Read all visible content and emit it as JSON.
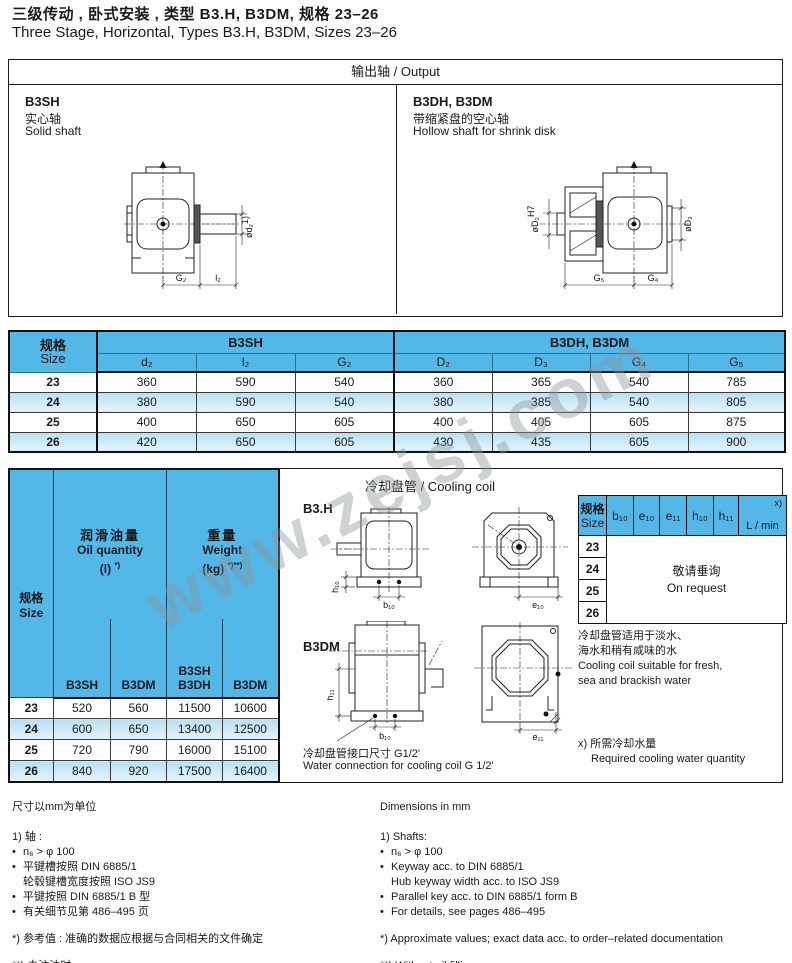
{
  "page": {
    "title_zh": "三级传动 , 卧式安装 , 类型 B3.H, B3DM, 规格 23–26",
    "title_en": "Three Stage, Horizontal, Types B3.H, B3DM, Sizes 23–26",
    "watermark": "www.zejsj.com"
  },
  "output": {
    "header": "输出轴 / Output",
    "left": {
      "type": "B3SH",
      "desc_zh": "实心轴",
      "desc_en": "Solid shaft",
      "labels": {
        "dia": "ød₂",
        "dia_sup": "1)",
        "g": "G₂",
        "l": "l₂"
      }
    },
    "right": {
      "type": "B3DH, B3DM",
      "desc_zh": "带缩紧盘的空心轴",
      "desc_en": "Hollow shaft for shrink disk",
      "labels": {
        "bore": "øD₂",
        "bore_sup": "H7",
        "d3": "øD₃",
        "g5": "G₅",
        "g4": "G₄"
      }
    }
  },
  "dim_table": {
    "size_zh": "规格",
    "size_en": "Size",
    "group1": "B3SH",
    "group2": "B3DH, B3DM",
    "cols": [
      "d₂",
      "l₂",
      "G₂",
      "D₂",
      "D₃",
      "G₄",
      "G₅"
    ],
    "rows": [
      {
        "size": "23",
        "v": [
          "360",
          "590",
          "540",
          "360",
          "365",
          "540",
          "785"
        ]
      },
      {
        "size": "24",
        "v": [
          "380",
          "590",
          "540",
          "380",
          "385",
          "540",
          "805"
        ]
      },
      {
        "size": "25",
        "v": [
          "400",
          "650",
          "605",
          "400",
          "405",
          "605",
          "875"
        ]
      },
      {
        "size": "26",
        "v": [
          "420",
          "650",
          "605",
          "430",
          "435",
          "605",
          "900"
        ]
      }
    ]
  },
  "oil_table": {
    "size_zh": "规格",
    "size_en": "Size",
    "oil_zh": "润滑油量",
    "oil_en": "Oil quantity",
    "oil_unit": "(l)",
    "oil_sup": "*)",
    "wt_zh": "重量",
    "wt_en": "Weight",
    "wt_unit": "(kg)",
    "wt_sup": "*)**)",
    "sub1": "B3SH",
    "sub2": "B3DM",
    "sub3a": "B3SH",
    "sub3b": "B3DH",
    "sub4": "B3DM",
    "rows": [
      {
        "size": "23",
        "v": [
          "520",
          "560",
          "11500",
          "10600"
        ]
      },
      {
        "size": "24",
        "v": [
          "600",
          "650",
          "13400",
          "12500"
        ]
      },
      {
        "size": "25",
        "v": [
          "720",
          "790",
          "16000",
          "15100"
        ]
      },
      {
        "size": "26",
        "v": [
          "840",
          "920",
          "17500",
          "16400"
        ]
      }
    ]
  },
  "cooling": {
    "title": "冷却盘管 / Cooling coil",
    "label_b3h": "B3.H",
    "label_b3dm": "B3DM",
    "labels": {
      "h10": "h₁₀",
      "b10": "b₁₀",
      "e10": "e₁₀",
      "h11": "h₁₁",
      "b10b": "b₁₀",
      "e11": "e₁₁"
    },
    "conn_zh": "冷却盘管接口尺寸 G1/2'",
    "conn_en": "Water connection for cooling coil G 1/2'",
    "table": {
      "size_zh": "规格",
      "size_en": "Size",
      "cols": [
        "b₁₀",
        "e₁₀",
        "e₁₁",
        "h₁₀",
        "h₁₁"
      ],
      "lmin": "L / min",
      "lmin_sup": "x)",
      "sizes": [
        "23",
        "24",
        "25",
        "26"
      ],
      "request_zh": "敬请垂询",
      "request_en": "On request"
    },
    "note_zh1": "冷却盘管适用于淡水、",
    "note_zh2": "海水和稍有咸味的水",
    "note_en1": "Cooling coil suitable for fresh,",
    "note_en2": "sea and brackish water",
    "x_zh": "x) 所需冷却水量",
    "x_en": "Required cooling water quantity"
  },
  "footnotes": {
    "zh": {
      "units": "尺寸以mm为单位",
      "head": "1) 轴 :",
      "b1": "n₆ > φ 100",
      "b2": "平键槽按照 DIN 6885/1",
      "b2b": "轮毂键槽宽度按照 ISO JS9",
      "b3": "平键按照 DIN 6885/1 B 型",
      "b4": "有关细节见第 486–495 页",
      "star": "*) 参考值 : 准确的数据应根据与合同相关的文件确定",
      "dstar": "**) 未注油时"
    },
    "en": {
      "units": "Dimensions in mm",
      "head": "1) Shafts:",
      "b1": "n₆ > φ 100",
      "b2": "Keyway acc. to DIN 6885/1",
      "b2b": "Hub keyway width acc. to ISO JS9",
      "b3": "Parallel key acc. to DIN 6885/1 form B",
      "b4": "For details, see pages 486–495",
      "star": "*) Approximate values; exact data acc. to order–related documentation",
      "dstar": "**) Without oil filling"
    }
  }
}
